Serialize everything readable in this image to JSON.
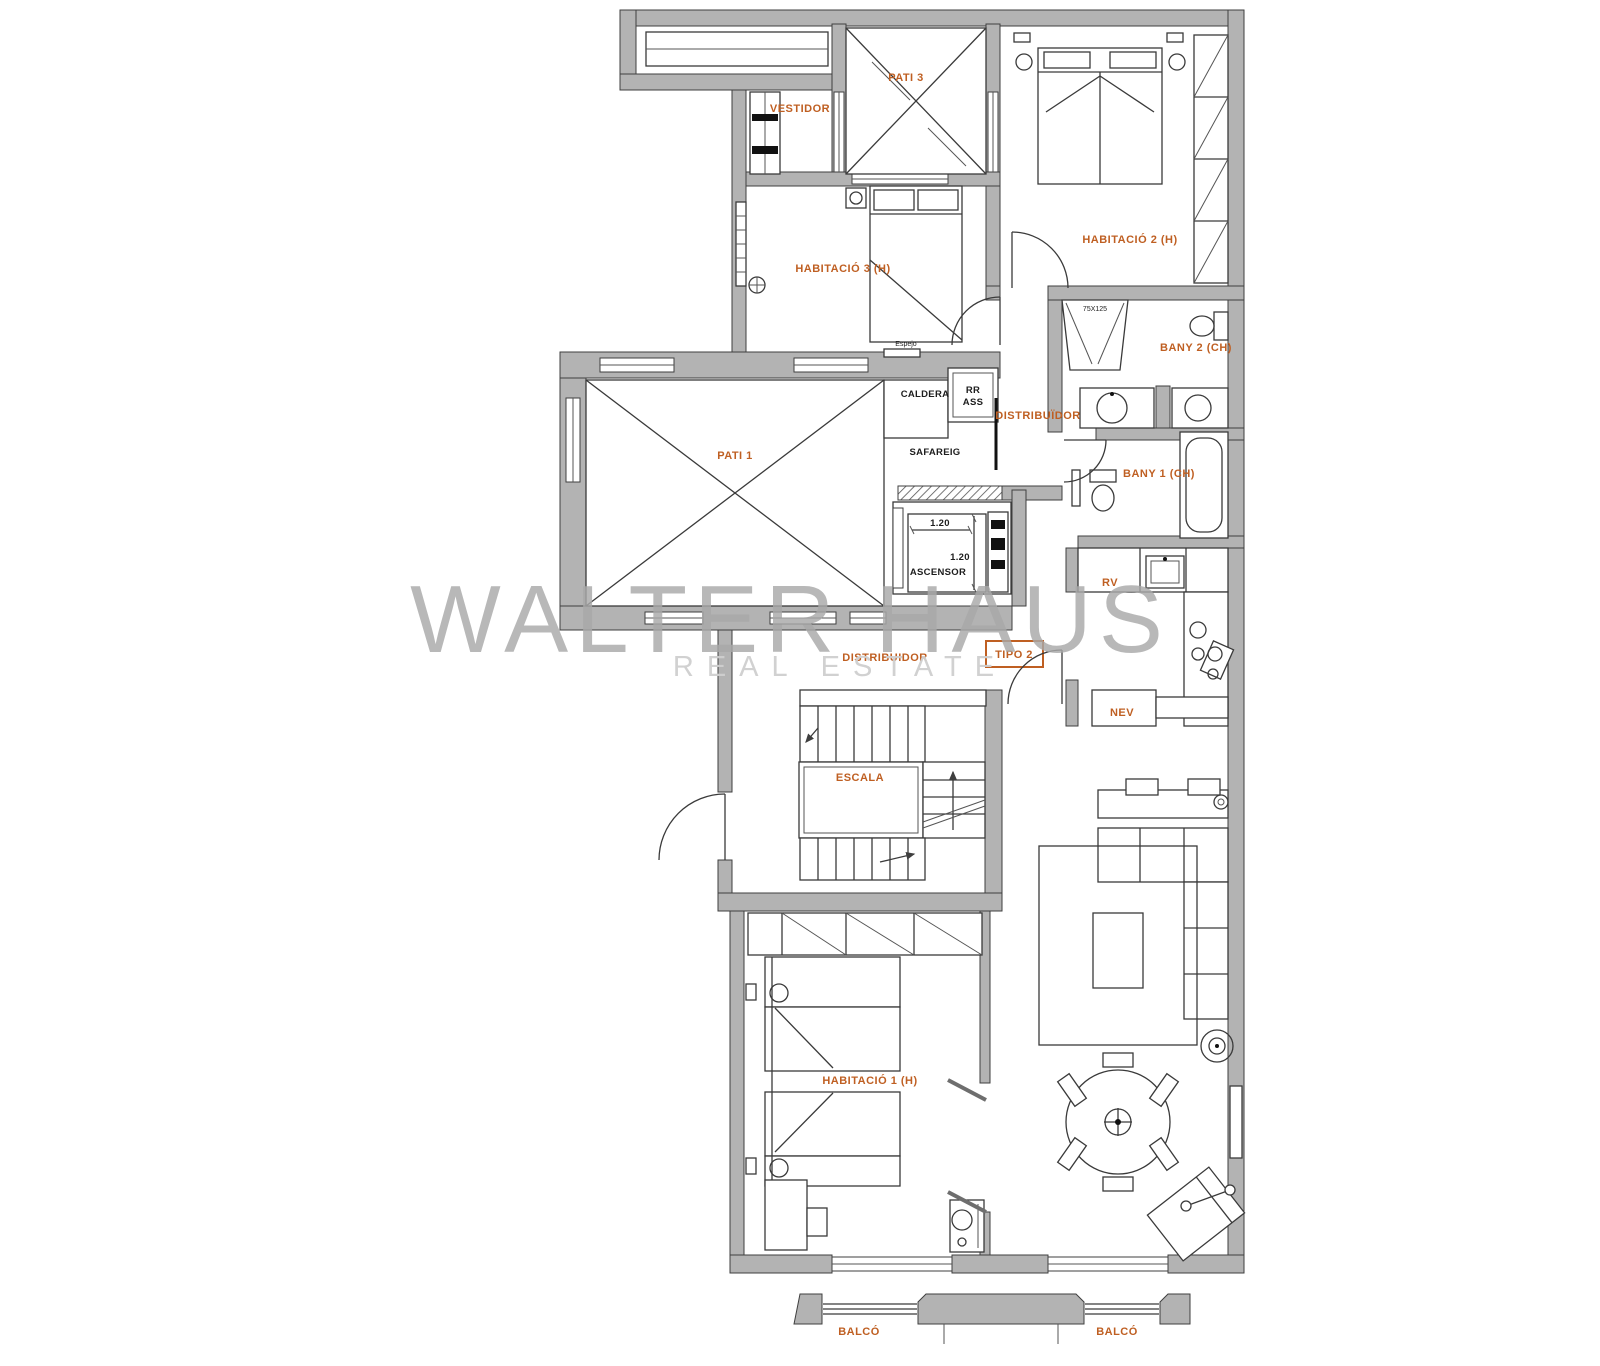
{
  "watermark": {
    "brand": "WALTER HAUS",
    "tagline": "REAL ESTATE"
  },
  "colors": {
    "label_accent": "#BF5F22",
    "wall_fill": "#B3B3B3",
    "line": "#3A3A3A",
    "watermark_primary": "#A9A9A9",
    "watermark_secondary": "#CFCFCF"
  },
  "rooms": {
    "pati_3": "PATI 3",
    "vestidor": "VESTIDOR",
    "habitacio_3": "HABITACIÓ 3 (H)",
    "habitacio_2": "HABITACIÓ 2 (H)",
    "bany_2": "BANY 2 (CH)",
    "distribuidor_superior": "DISTRIBUÏDOR",
    "caldera": "CALDERA",
    "rr": "RR",
    "ass": "ASS",
    "safareig": "SAFAREIG",
    "pati_1": "PATI 1",
    "bany_1": "BANY 1 (CH)",
    "ascensor": "ASCENSOR",
    "rv": "RV",
    "nev": "NEV",
    "distribuidor": "DISTRIBUIDOR",
    "escala": "ESCALA",
    "habitacio_1": "HABITACIÓ 1 (H)",
    "balco_esquerre": "BALCÓ",
    "balco_dret": "BALCÓ"
  },
  "annotations": {
    "tipus": "TIPO 2",
    "ascensor_ample": "1.20",
    "ascensor_fons": "1.20",
    "mirall": "75X125",
    "espejo": "Espejo"
  }
}
